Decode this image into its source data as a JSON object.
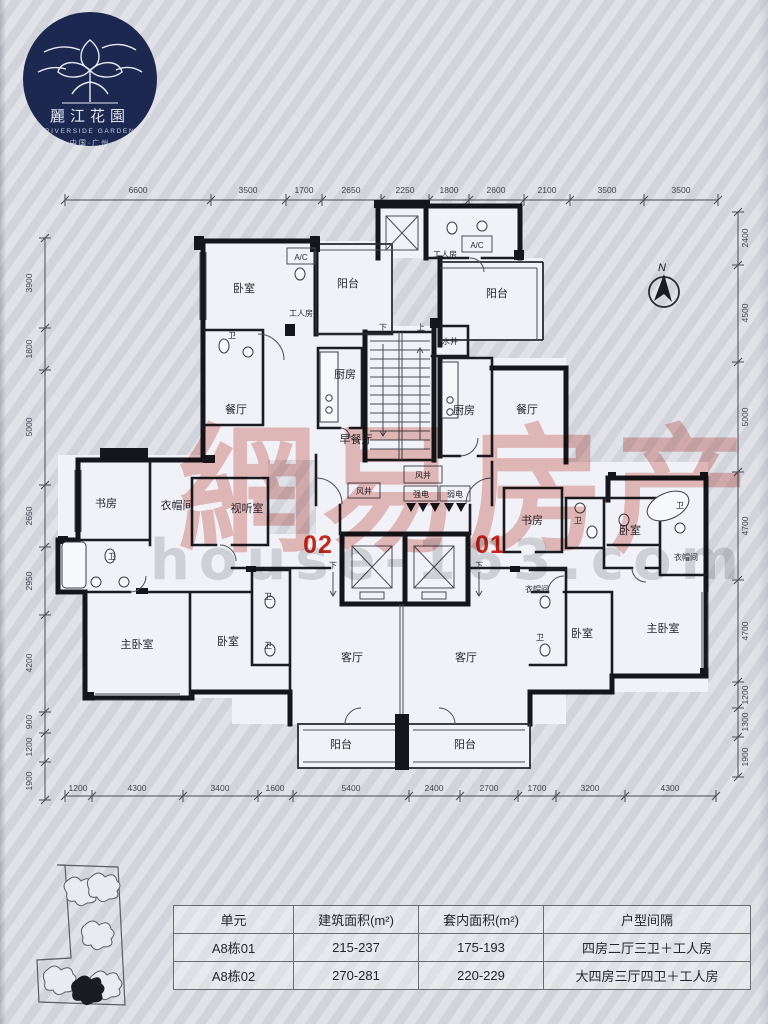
{
  "logo": {
    "brand": "麗江花園",
    "brand_en": "RIVERSIDE GARDEN",
    "location": "中国·广州"
  },
  "compass": {
    "north": "N"
  },
  "watermark": {
    "cn": "網易房产",
    "url": "house-163.com"
  },
  "plan": {
    "unit_left": "02",
    "unit_right": "01",
    "accent_red": "#c5281c",
    "rooms": {
      "bedroom": "卧室",
      "master": "主卧室",
      "living": "客厅",
      "dining": "餐厅",
      "breakfast": "早餐厅",
      "kitchen": "厨房",
      "balcony": "阳台",
      "worker": "工人房",
      "study": "书房",
      "cloak": "衣帽间",
      "av": "视听室",
      "bath": "卫",
      "ac": "A/C",
      "water": "水井",
      "air": "风井",
      "strong": "强电",
      "weak": "弱电",
      "up": "上",
      "down": "下"
    },
    "dims": {
      "top": [
        "6600",
        "3500",
        "1700",
        "2650",
        "2250",
        "1800",
        "2600",
        "2100",
        "3500",
        "3500"
      ],
      "bottom": [
        "1200",
        "4300",
        "3400",
        "1600",
        "5400",
        "2400",
        "2700",
        "1700",
        "3200",
        "4300"
      ],
      "left": [
        "3900",
        "1800",
        "5000",
        "2650",
        "2950",
        "4200",
        "900",
        "1200",
        "1900"
      ],
      "right": [
        "2400",
        "4500",
        "5000",
        "4700",
        "4700",
        "1200",
        "1300",
        "1900"
      ]
    }
  },
  "table": {
    "headers": [
      "单元",
      "建筑面积(m²)",
      "套内面积(m²)",
      "户型间隔"
    ],
    "rows": [
      [
        "A8栋01",
        "215-237",
        "175-193",
        "四房二厅三卫＋工人房"
      ],
      [
        "A8栋02",
        "270-281",
        "220-229",
        "大四房三厅四卫＋工人房"
      ]
    ]
  }
}
